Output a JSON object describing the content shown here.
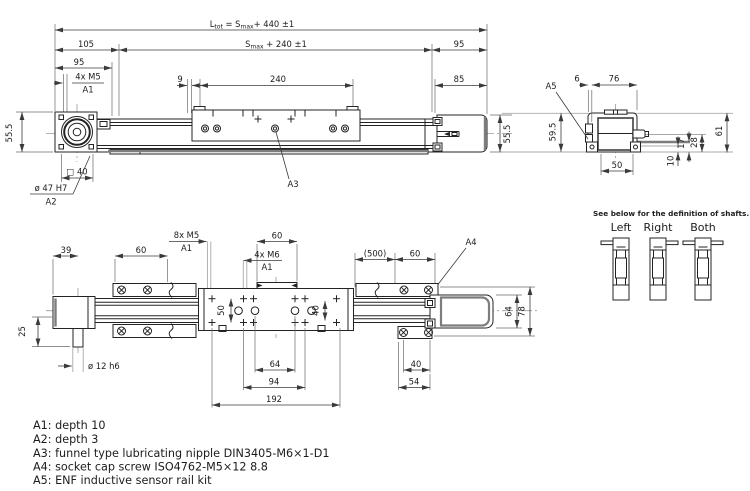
{
  "front_view": {
    "dim_ltot_l": "L",
    "dim_ltot_sub1": "tot",
    "dim_ltot_mid": " = S",
    "dim_ltot_sub2": "max",
    "dim_ltot_tail": "+ 440 ±1",
    "dim_smax_s": "S",
    "dim_smax_sub": "max",
    "dim_smax_tail": " + 240 ±1",
    "dim_105": "105",
    "dim_95_right": "95",
    "dim_95_left": "95",
    "thread_m5": "4x M5",
    "thread_m5_ref": "A1",
    "dim_9": "9",
    "dim_240": "240",
    "dim_85": "85",
    "dim_height_left": "55.5",
    "dim_height_right": "55.5",
    "dim_square": "□ 40",
    "dim_bore": "ø 47 H7",
    "bore_ref": "A2",
    "nipple_ref": "A3"
  },
  "side_view": {
    "dim_6": "6",
    "dim_76": "76",
    "sensor_ref": "A5",
    "dim_595": "59.5",
    "dim_61": "61",
    "dim_50": "50",
    "dim_10": "10",
    "dim_17": "17",
    "dim_28": "28"
  },
  "shaft_defs": {
    "title": "See below for the definition of shafts.",
    "left": "Left",
    "right": "Right",
    "both": "Both"
  },
  "bottom_view": {
    "thread_m5": "8x M5",
    "thread_m5_ref": "A1",
    "dim_60_top": "60",
    "thread_m6": "4x M6",
    "thread_m6_ref": "A1",
    "dim_500": "(500)",
    "dim_60_right": "60",
    "screw_ref": "A4",
    "dim_39": "39",
    "dim_60_left": "60",
    "dim_25": "25",
    "dim_shaft": "ø 12 h6",
    "dim_50": "50",
    "dim_40_carriage": "40",
    "dim_64": "64",
    "dim_94": "94",
    "dim_192": "192",
    "dim_40_rail": "40",
    "dim_54": "54",
    "dim_64_right": "64",
    "dim_78": "78"
  },
  "notes": {
    "a1": "A1: depth 10",
    "a2": "A2: depth 3",
    "a3": "A3: funnel type lubricating nipple DIN3405-M6×1-D1",
    "a4": "A4: socket cap screw ISO4762-M5×12 8.8",
    "a5": "A5: ENF inductive sensor rail kit"
  }
}
